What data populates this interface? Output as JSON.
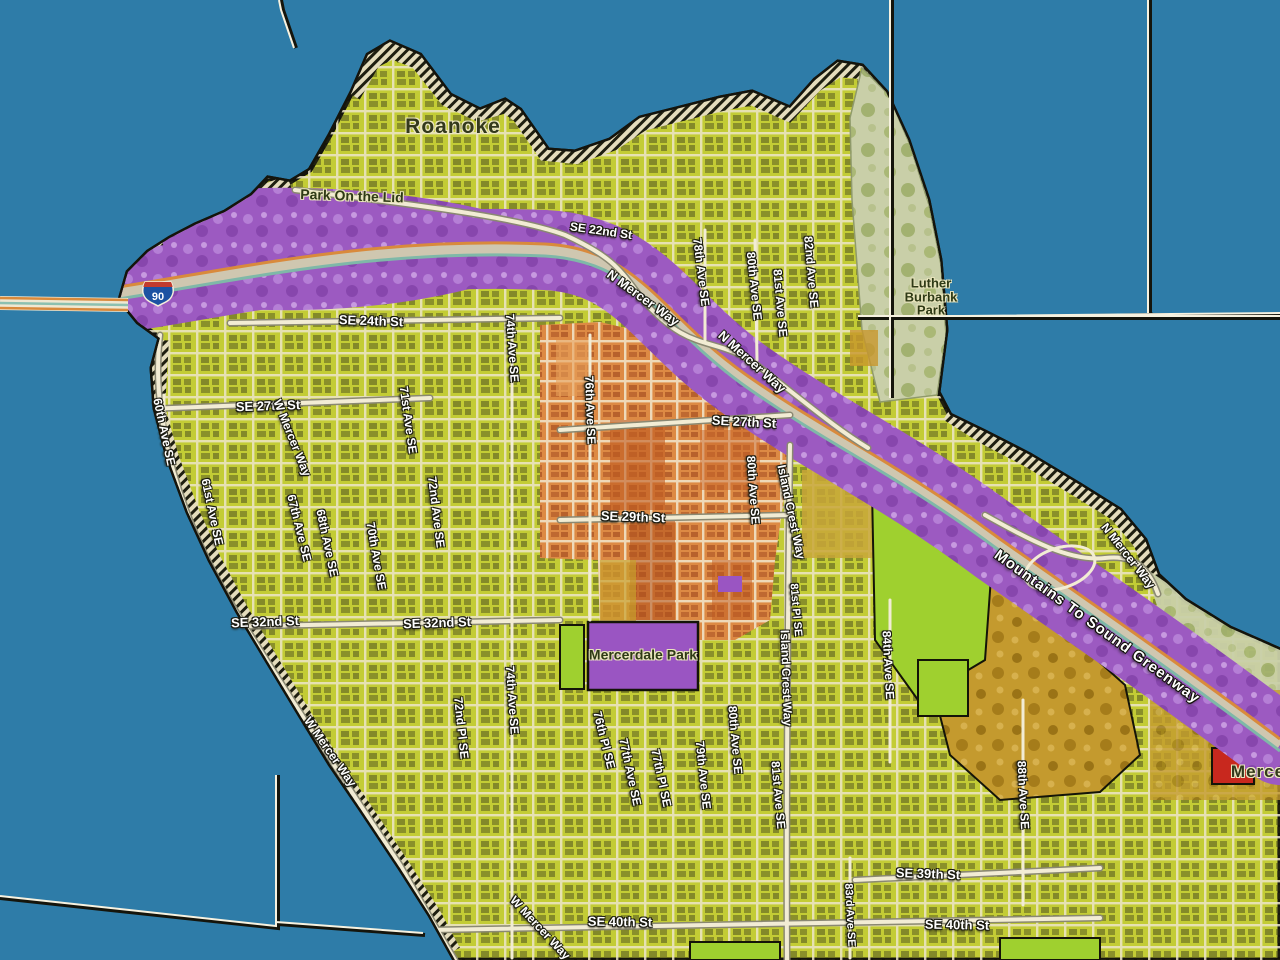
{
  "map": {
    "shield": {
      "number": "90"
    },
    "palette": {
      "water": "#2e7ca8",
      "residential_yellow_green": "#c3cc35",
      "street_cream": "#efe8cf",
      "parcel_dark": "#2e2e18",
      "freeway_corridor_purple": "#9c5ac1",
      "park_purple": "#9a55c2",
      "town_center_orange": "#dd8a44",
      "town_center_dark_orange": "#bf5a22",
      "open_space_green": "#9fd02f",
      "park_sage": "#c9cfa8",
      "wooded_gold": "#c49a2e",
      "red_parcel": "#c8281e",
      "shield_blue": "#1c52a2",
      "shield_red": "#c23b2e",
      "boundary_light": "#f7f2e0",
      "boundary_dark": "#15150c"
    },
    "labels": [
      {
        "id": "roanoke",
        "text": "Roanoke",
        "x": 453,
        "y": 127,
        "rot": 0,
        "size": 21,
        "style": "place"
      },
      {
        "id": "park-on-the-lid",
        "text": "Park On the Lid",
        "x": 352,
        "y": 196,
        "rot": 2,
        "size": 14,
        "style": "park"
      },
      {
        "id": "se-22nd-st",
        "text": "SE 22nd St",
        "x": 601,
        "y": 231,
        "rot": 8,
        "size": 12,
        "style": "street"
      },
      {
        "id": "luther-burbank-park",
        "text": "Luther\nBurbank\nPark",
        "x": 931,
        "y": 297,
        "rot": 0,
        "size": 13,
        "style": "park"
      },
      {
        "id": "n-mercer-way-1",
        "text": "N Mercer Way",
        "x": 643,
        "y": 298,
        "rot": 36,
        "size": 13,
        "style": "street"
      },
      {
        "id": "n-mercer-way-2",
        "text": "N Mercer Way",
        "x": 752,
        "y": 362,
        "rot": 42,
        "size": 13,
        "style": "street"
      },
      {
        "id": "n-mercer-way-3",
        "text": "N Mercer Way",
        "x": 1128,
        "y": 556,
        "rot": 52,
        "size": 12,
        "style": "street"
      },
      {
        "id": "se-24th-st",
        "text": "SE 24th St",
        "x": 371,
        "y": 321,
        "rot": 2,
        "size": 13,
        "style": "street"
      },
      {
        "id": "78th-ave-se",
        "text": "78th Ave SE",
        "x": 701,
        "y": 272,
        "rot": 83,
        "size": 12,
        "style": "street"
      },
      {
        "id": "80th-ave-se-1",
        "text": "80th Ave SE",
        "x": 754,
        "y": 286,
        "rot": 84,
        "size": 12,
        "style": "street"
      },
      {
        "id": "81st-ave-se-1",
        "text": "81st Ave SE",
        "x": 780,
        "y": 303,
        "rot": 85,
        "size": 12,
        "style": "street"
      },
      {
        "id": "82nd-ave-se",
        "text": "82nd Ave SE",
        "x": 811,
        "y": 272,
        "rot": 85,
        "size": 12,
        "style": "street"
      },
      {
        "id": "se-27th-st-1",
        "text": "SE 27th St",
        "x": 268,
        "y": 406,
        "rot": -2,
        "size": 13,
        "style": "street"
      },
      {
        "id": "60th-ave-se",
        "text": "60th Ave SE",
        "x": 164,
        "y": 432,
        "rot": 78,
        "size": 12,
        "style": "street"
      },
      {
        "id": "61st-ave-se",
        "text": "61st Ave SE",
        "x": 212,
        "y": 512,
        "rot": 78,
        "size": 12,
        "style": "street"
      },
      {
        "id": "w-mercer-way-1",
        "text": "W Mercer Way",
        "x": 292,
        "y": 438,
        "rot": 68,
        "size": 12,
        "style": "street"
      },
      {
        "id": "67th-ave-se",
        "text": "67th Ave SE",
        "x": 299,
        "y": 528,
        "rot": 76,
        "size": 12,
        "style": "street"
      },
      {
        "id": "68th-ave-se",
        "text": "68th Ave SE",
        "x": 327,
        "y": 543,
        "rot": 78,
        "size": 12,
        "style": "street"
      },
      {
        "id": "70th-ave-se",
        "text": "70th Ave SE",
        "x": 376,
        "y": 556,
        "rot": 80,
        "size": 12,
        "style": "street"
      },
      {
        "id": "71st-ave-se",
        "text": "71st Ave SE",
        "x": 408,
        "y": 420,
        "rot": 82,
        "size": 12,
        "style": "street"
      },
      {
        "id": "72nd-ave-se",
        "text": "72nd Ave SE",
        "x": 436,
        "y": 512,
        "rot": 83,
        "size": 12,
        "style": "street"
      },
      {
        "id": "74th-ave-se-1",
        "text": "74th Ave SE",
        "x": 512,
        "y": 348,
        "rot": 86,
        "size": 12,
        "style": "street"
      },
      {
        "id": "76th-ave-se",
        "text": "76th Ave SE",
        "x": 590,
        "y": 410,
        "rot": 88,
        "size": 12,
        "style": "street"
      },
      {
        "id": "se-27th-st-2",
        "text": "SE 27th St",
        "x": 744,
        "y": 422,
        "rot": 3,
        "size": 13,
        "style": "street"
      },
      {
        "id": "se-29th-st",
        "text": "SE 29th St",
        "x": 633,
        "y": 517,
        "rot": 2,
        "size": 13,
        "style": "street"
      },
      {
        "id": "80th-ave-se-2",
        "text": "80th Ave SE",
        "x": 753,
        "y": 490,
        "rot": 86,
        "size": 12,
        "style": "street"
      },
      {
        "id": "island-crest-way-1",
        "text": "Island Crest Way",
        "x": 791,
        "y": 512,
        "rot": 78,
        "size": 12,
        "style": "street"
      },
      {
        "id": "island-crest-way-2",
        "text": "Island Crest Way",
        "x": 786,
        "y": 678,
        "rot": 88,
        "size": 12,
        "style": "street"
      },
      {
        "id": "se-32nd-st-1",
        "text": "SE 32nd St",
        "x": 265,
        "y": 622,
        "rot": -2,
        "size": 13,
        "style": "street"
      },
      {
        "id": "se-32nd-st-2",
        "text": "SE 32nd St",
        "x": 437,
        "y": 623,
        "rot": -2,
        "size": 13,
        "style": "street"
      },
      {
        "id": "mercerdale-park",
        "text": "Mercerdale Park",
        "x": 643,
        "y": 655,
        "rot": 0,
        "size": 14,
        "style": "park"
      },
      {
        "id": "74th-ave-se-2",
        "text": "74th Ave SE",
        "x": 512,
        "y": 700,
        "rot": 86,
        "size": 12,
        "style": "street"
      },
      {
        "id": "72nd-pl-se",
        "text": "72nd Pl SE",
        "x": 461,
        "y": 728,
        "rot": 84,
        "size": 12,
        "style": "street"
      },
      {
        "id": "76th-pl-se",
        "text": "76th Pl SE",
        "x": 604,
        "y": 740,
        "rot": 76,
        "size": 12,
        "style": "street"
      },
      {
        "id": "77th-ave-se",
        "text": "77th Ave SE",
        "x": 630,
        "y": 772,
        "rot": 78,
        "size": 12,
        "style": "street"
      },
      {
        "id": "77th-pl-se",
        "text": "77th Pl SE",
        "x": 661,
        "y": 778,
        "rot": 78,
        "size": 12,
        "style": "street"
      },
      {
        "id": "79th-ave-se",
        "text": "79th Ave SE",
        "x": 703,
        "y": 775,
        "rot": 84,
        "size": 12,
        "style": "street"
      },
      {
        "id": "80th-ave-se-3",
        "text": "80th Ave SE",
        "x": 735,
        "y": 740,
        "rot": 85,
        "size": 12,
        "style": "street"
      },
      {
        "id": "81st-ave-se-2",
        "text": "81st Ave SE",
        "x": 778,
        "y": 795,
        "rot": 85,
        "size": 12,
        "style": "street"
      },
      {
        "id": "81st-pl-se",
        "text": "81st Pl SE",
        "x": 795,
        "y": 610,
        "rot": 85,
        "size": 11,
        "style": "street"
      },
      {
        "id": "84th-ave-se",
        "text": "84th Ave SE",
        "x": 888,
        "y": 665,
        "rot": 87,
        "size": 12,
        "style": "street"
      },
      {
        "id": "88th-ave-se",
        "text": "88th Ave SE",
        "x": 1023,
        "y": 795,
        "rot": 87,
        "size": 12,
        "style": "street"
      },
      {
        "id": "83rd-ave-se",
        "text": "83rd Ave SE",
        "x": 849,
        "y": 915,
        "rot": 87,
        "size": 11,
        "style": "street"
      },
      {
        "id": "se-39th-st",
        "text": "SE 39th St",
        "x": 928,
        "y": 874,
        "rot": 2,
        "size": 13,
        "style": "street"
      },
      {
        "id": "se-40th-st-1",
        "text": "SE 40th St",
        "x": 620,
        "y": 922,
        "rot": 1,
        "size": 13,
        "style": "street"
      },
      {
        "id": "se-40th-st-2",
        "text": "SE 40th St",
        "x": 957,
        "y": 925,
        "rot": 1,
        "size": 13,
        "style": "street"
      },
      {
        "id": "w-mercer-way-2",
        "text": "W Mercer Way",
        "x": 330,
        "y": 752,
        "rot": 55,
        "size": 12,
        "style": "street"
      },
      {
        "id": "w-mercer-way-3",
        "text": "W Mercer Way",
        "x": 540,
        "y": 928,
        "rot": 47,
        "size": 12,
        "style": "street"
      },
      {
        "id": "mountains-to-sound-greenway",
        "text": "Mountains To Sound Greenway",
        "x": 1097,
        "y": 627,
        "rot": 36,
        "size": 15,
        "style": "corridor"
      },
      {
        "id": "mercer-clipped",
        "text": "Merce",
        "x": 1258,
        "y": 772,
        "rot": 0,
        "size": 17,
        "style": "place"
      }
    ]
  }
}
